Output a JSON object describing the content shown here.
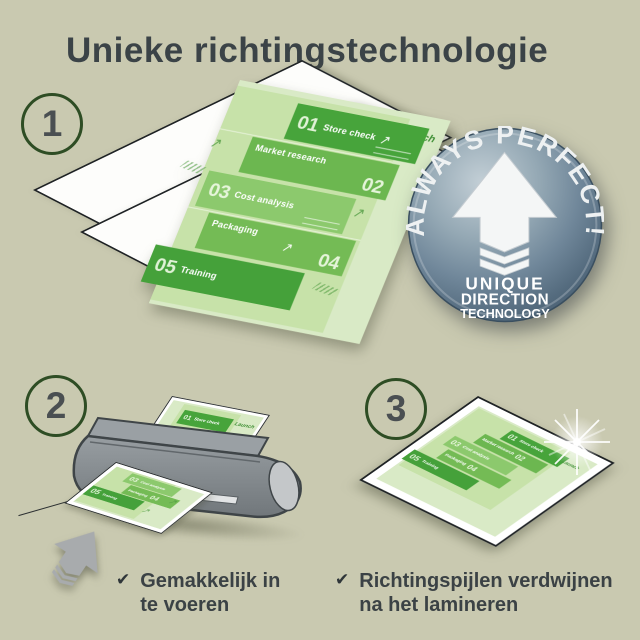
{
  "title": "Unieke richtingstechnologie",
  "step_numbers": [
    "1",
    "2",
    "3"
  ],
  "badge": {
    "arc": "ALWAYS PERFECT!",
    "lines": [
      "UNIQUE",
      "DIRECTION",
      "TECHNOLOGY"
    ]
  },
  "sample_document": {
    "items": [
      {
        "num": "01",
        "label": "Store check"
      },
      {
        "num": "02",
        "label": "Market research"
      },
      {
        "num": "03",
        "label": "Cost analysis"
      },
      {
        "num": "04",
        "label": "Packaging"
      },
      {
        "num": "05",
        "label": "Training"
      }
    ],
    "corner_label": "Launch"
  },
  "captions": [
    {
      "check": "✔",
      "line1": "Gemakkelijk in",
      "line2": "te voeren"
    },
    {
      "check": "✔",
      "line1": "Richtingspijlen verdwijnen",
      "line2": "na het lamineren"
    }
  ],
  "icons": {
    "doodle_arrow": "↗"
  },
  "colors": {
    "background": "#c9c9b0",
    "heading": "#3b4347",
    "circle_ring": "#2e4d24",
    "green_dark": "#47a43b",
    "green_mid": "#6cb750",
    "green_light": "#8cc96d",
    "page_green": "#d9eac6",
    "badge_face": "#7c92a2",
    "machine_gray": "#868c90"
  }
}
